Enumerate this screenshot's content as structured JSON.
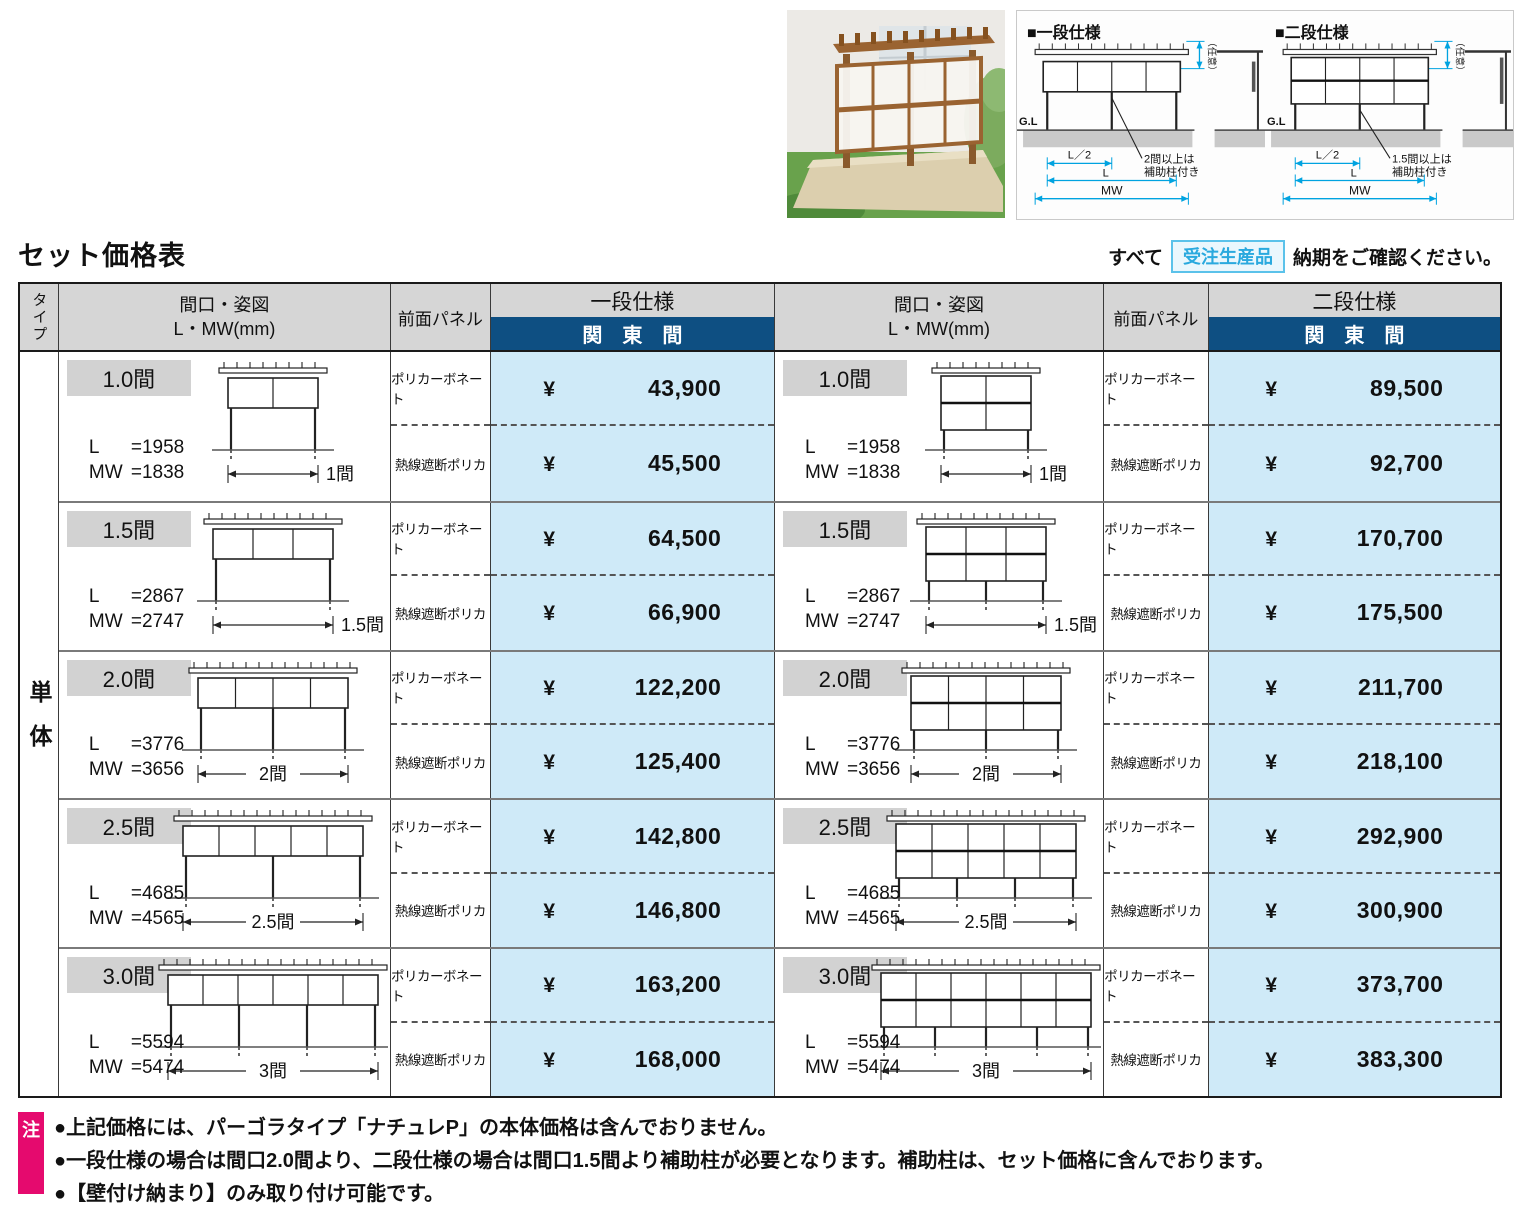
{
  "page": {
    "title": "セット価格表",
    "order_prefix": "すべて",
    "order_badge": "受注生産品",
    "order_suffix": "納期をご確認ください。"
  },
  "diagrams": {
    "shared": {
      "gl": "G.L",
      "half": "L／2",
      "l": "L",
      "mw": "MW",
      "optional": "（任意）"
    },
    "one": {
      "title": "■一段仕様",
      "note1": "2間以上は",
      "note2": "補助柱付き"
    },
    "two": {
      "title": "■二段仕様",
      "note1": "1.5間以上は",
      "note2": "補助柱付き"
    }
  },
  "table": {
    "type_header": "タイプ",
    "type_value": "単体",
    "col_facade_1": "間口・姿図",
    "col_facade_2": "L・MW(mm)",
    "col_panel": "前面パネル",
    "col_one_tier": "一段仕様",
    "col_two_tier": "二段仕様",
    "col_kanto": "関　東　間",
    "currency": "¥",
    "panel_types": [
      "ポリカーボネート",
      "熱線遮断ポリカ"
    ],
    "rows": [
      {
        "size": "1.0間",
        "l_name": "L",
        "l_val": "=1958",
        "mw_name": "MW",
        "mw_val": "=1838",
        "dim": "1間",
        "cols": 2,
        "posts_one": 2,
        "posts_two": 2,
        "one": [
          "43,900",
          "45,500"
        ],
        "two": [
          "89,500",
          "92,700"
        ]
      },
      {
        "size": "1.5間",
        "l_name": "L",
        "l_val": "=2867",
        "mw_name": "MW",
        "mw_val": "=2747",
        "dim": "1.5間",
        "cols": 3,
        "posts_one": 2,
        "posts_two": 3,
        "one": [
          "64,500",
          "66,900"
        ],
        "two": [
          "170,700",
          "175,500"
        ]
      },
      {
        "size": "2.0間",
        "l_name": "L",
        "l_val": "=3776",
        "mw_name": "MW",
        "mw_val": "=3656",
        "dim": "2間",
        "cols": 4,
        "posts_one": 3,
        "posts_two": 3,
        "one": [
          "122,200",
          "125,400"
        ],
        "two": [
          "211,700",
          "218,100"
        ]
      },
      {
        "size": "2.5間",
        "l_name": "L",
        "l_val": "=4685",
        "mw_name": "MW",
        "mw_val": "=4565",
        "dim": "2.5間",
        "cols": 5,
        "posts_one": 3,
        "posts_two": 4,
        "one": [
          "142,800",
          "146,800"
        ],
        "two": [
          "292,900",
          "300,900"
        ]
      },
      {
        "size": "3.0間",
        "l_name": "L",
        "l_val": "=5594",
        "mw_name": "MW",
        "mw_val": "=5474",
        "dim": "3間",
        "cols": 6,
        "posts_one": 4,
        "posts_two": 5,
        "one": [
          "163,200",
          "168,000"
        ],
        "two": [
          "373,700",
          "383,300"
        ]
      }
    ]
  },
  "notes": {
    "marker": "注",
    "items": [
      "●上記価格には、パーゴラタイプ「ナチュレP」の本体価格は含んでおりません。",
      "●一段仕様の場合は間口2.0間より、二段仕様の場合は間口1.5間より補助柱が必要となります。補助柱は、セット価格に含んでおります。",
      "●【壁付け納まり】のみ取り付け可能です。"
    ]
  }
}
